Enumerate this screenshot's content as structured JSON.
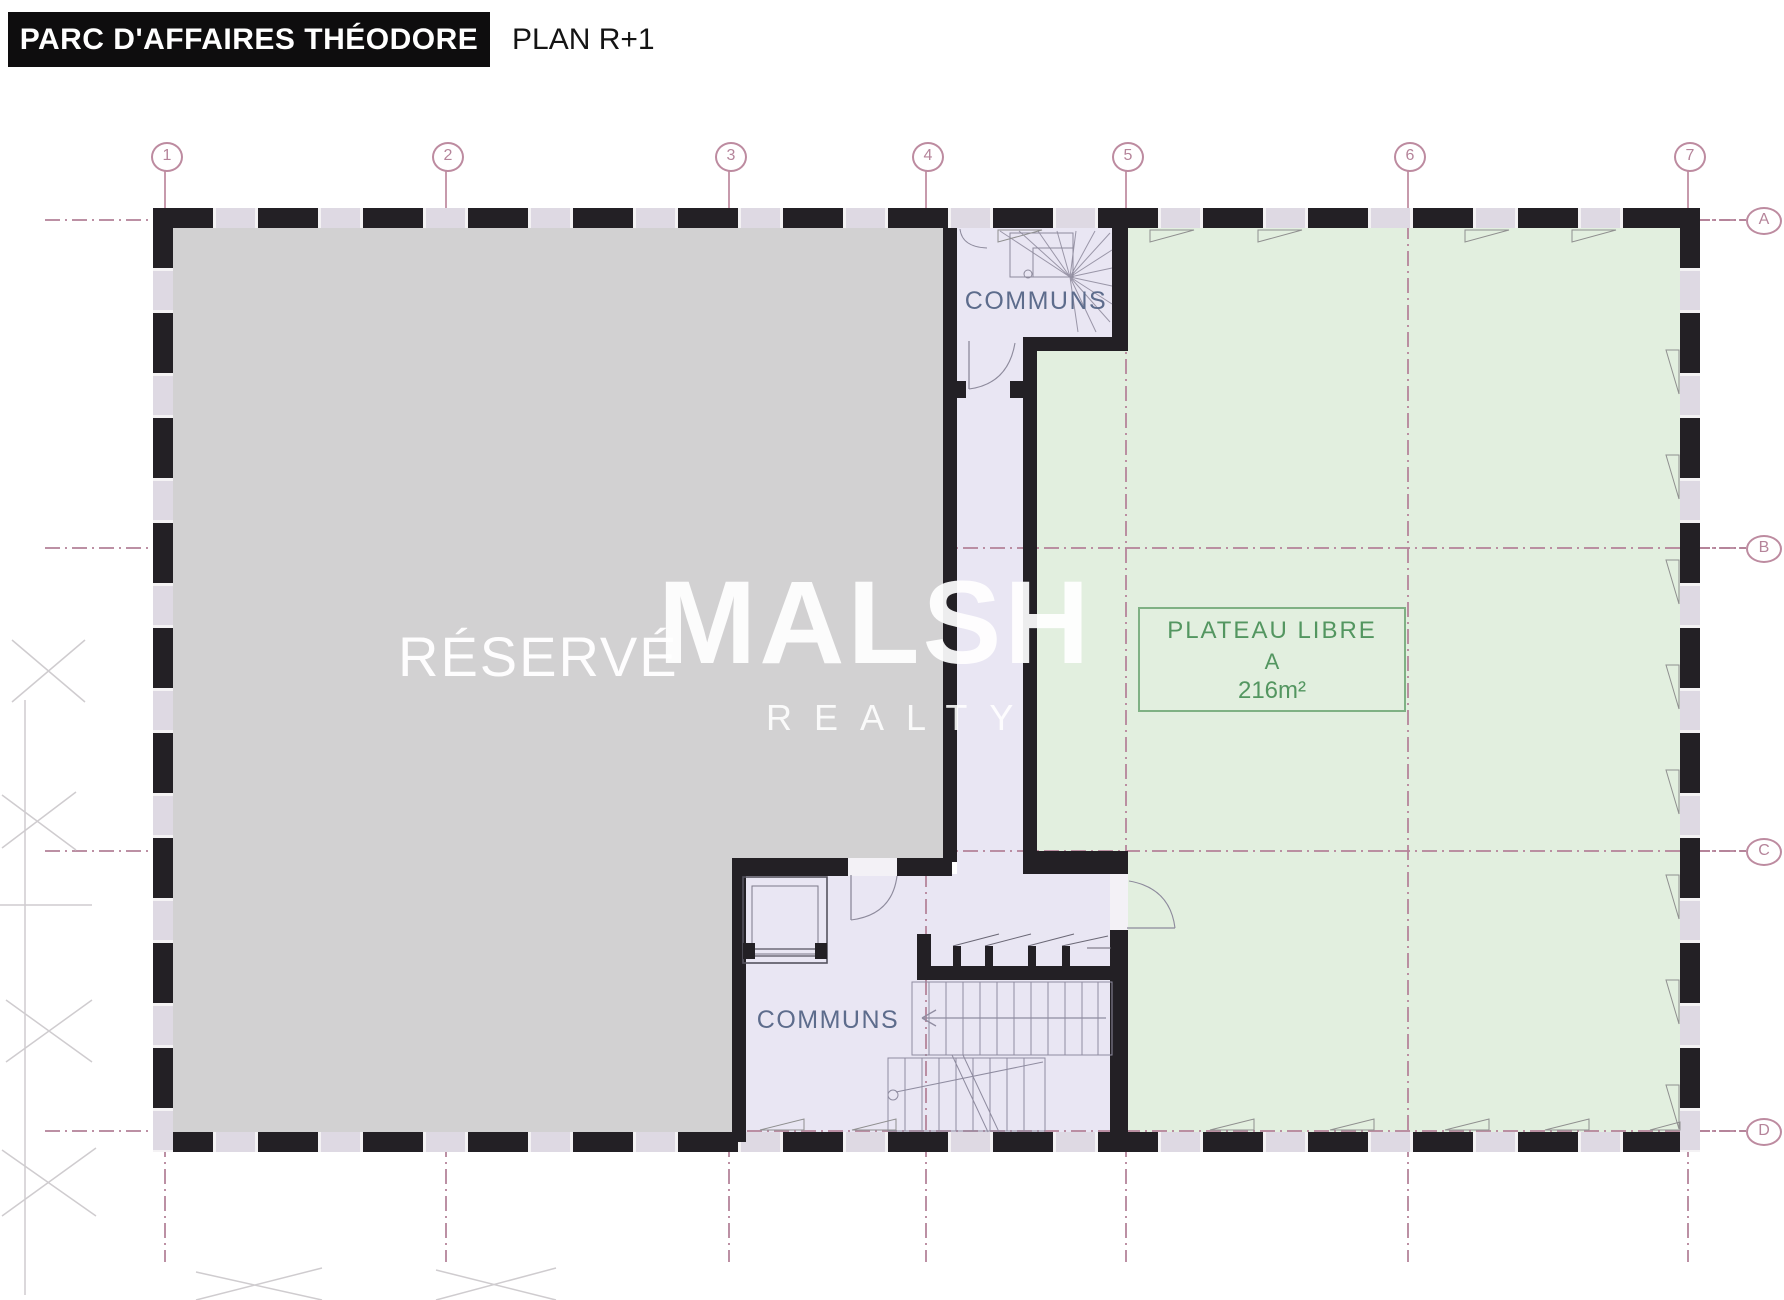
{
  "banner": {
    "project": "PARC D'AFFAIRES THÉODORE",
    "plan": "PLAN R+1"
  },
  "watermark": {
    "brand": "MALSH",
    "sub": "REALTY"
  },
  "rooms": {
    "reserved": "RÉSERVÉ",
    "commons_top": "COMMUNS",
    "commons_bottom": "COMMUNS",
    "plateau": {
      "title": "PLATEAU LIBRE",
      "unit": "A",
      "area": "216m²"
    }
  },
  "grid": {
    "columns": [
      "1",
      "2",
      "3",
      "4",
      "5",
      "6",
      "7"
    ],
    "rows": [
      "A",
      "B",
      "C",
      "D"
    ]
  },
  "colors": {
    "reserved_fill": "#d2d1d2",
    "plateau_fill": "#e2efdf",
    "commons_fill": "#e9e6f3",
    "wall": "#232025",
    "grid_line": "#b5849a",
    "commons_text": "#5d6c8c",
    "plateau_text": "#539660"
  }
}
